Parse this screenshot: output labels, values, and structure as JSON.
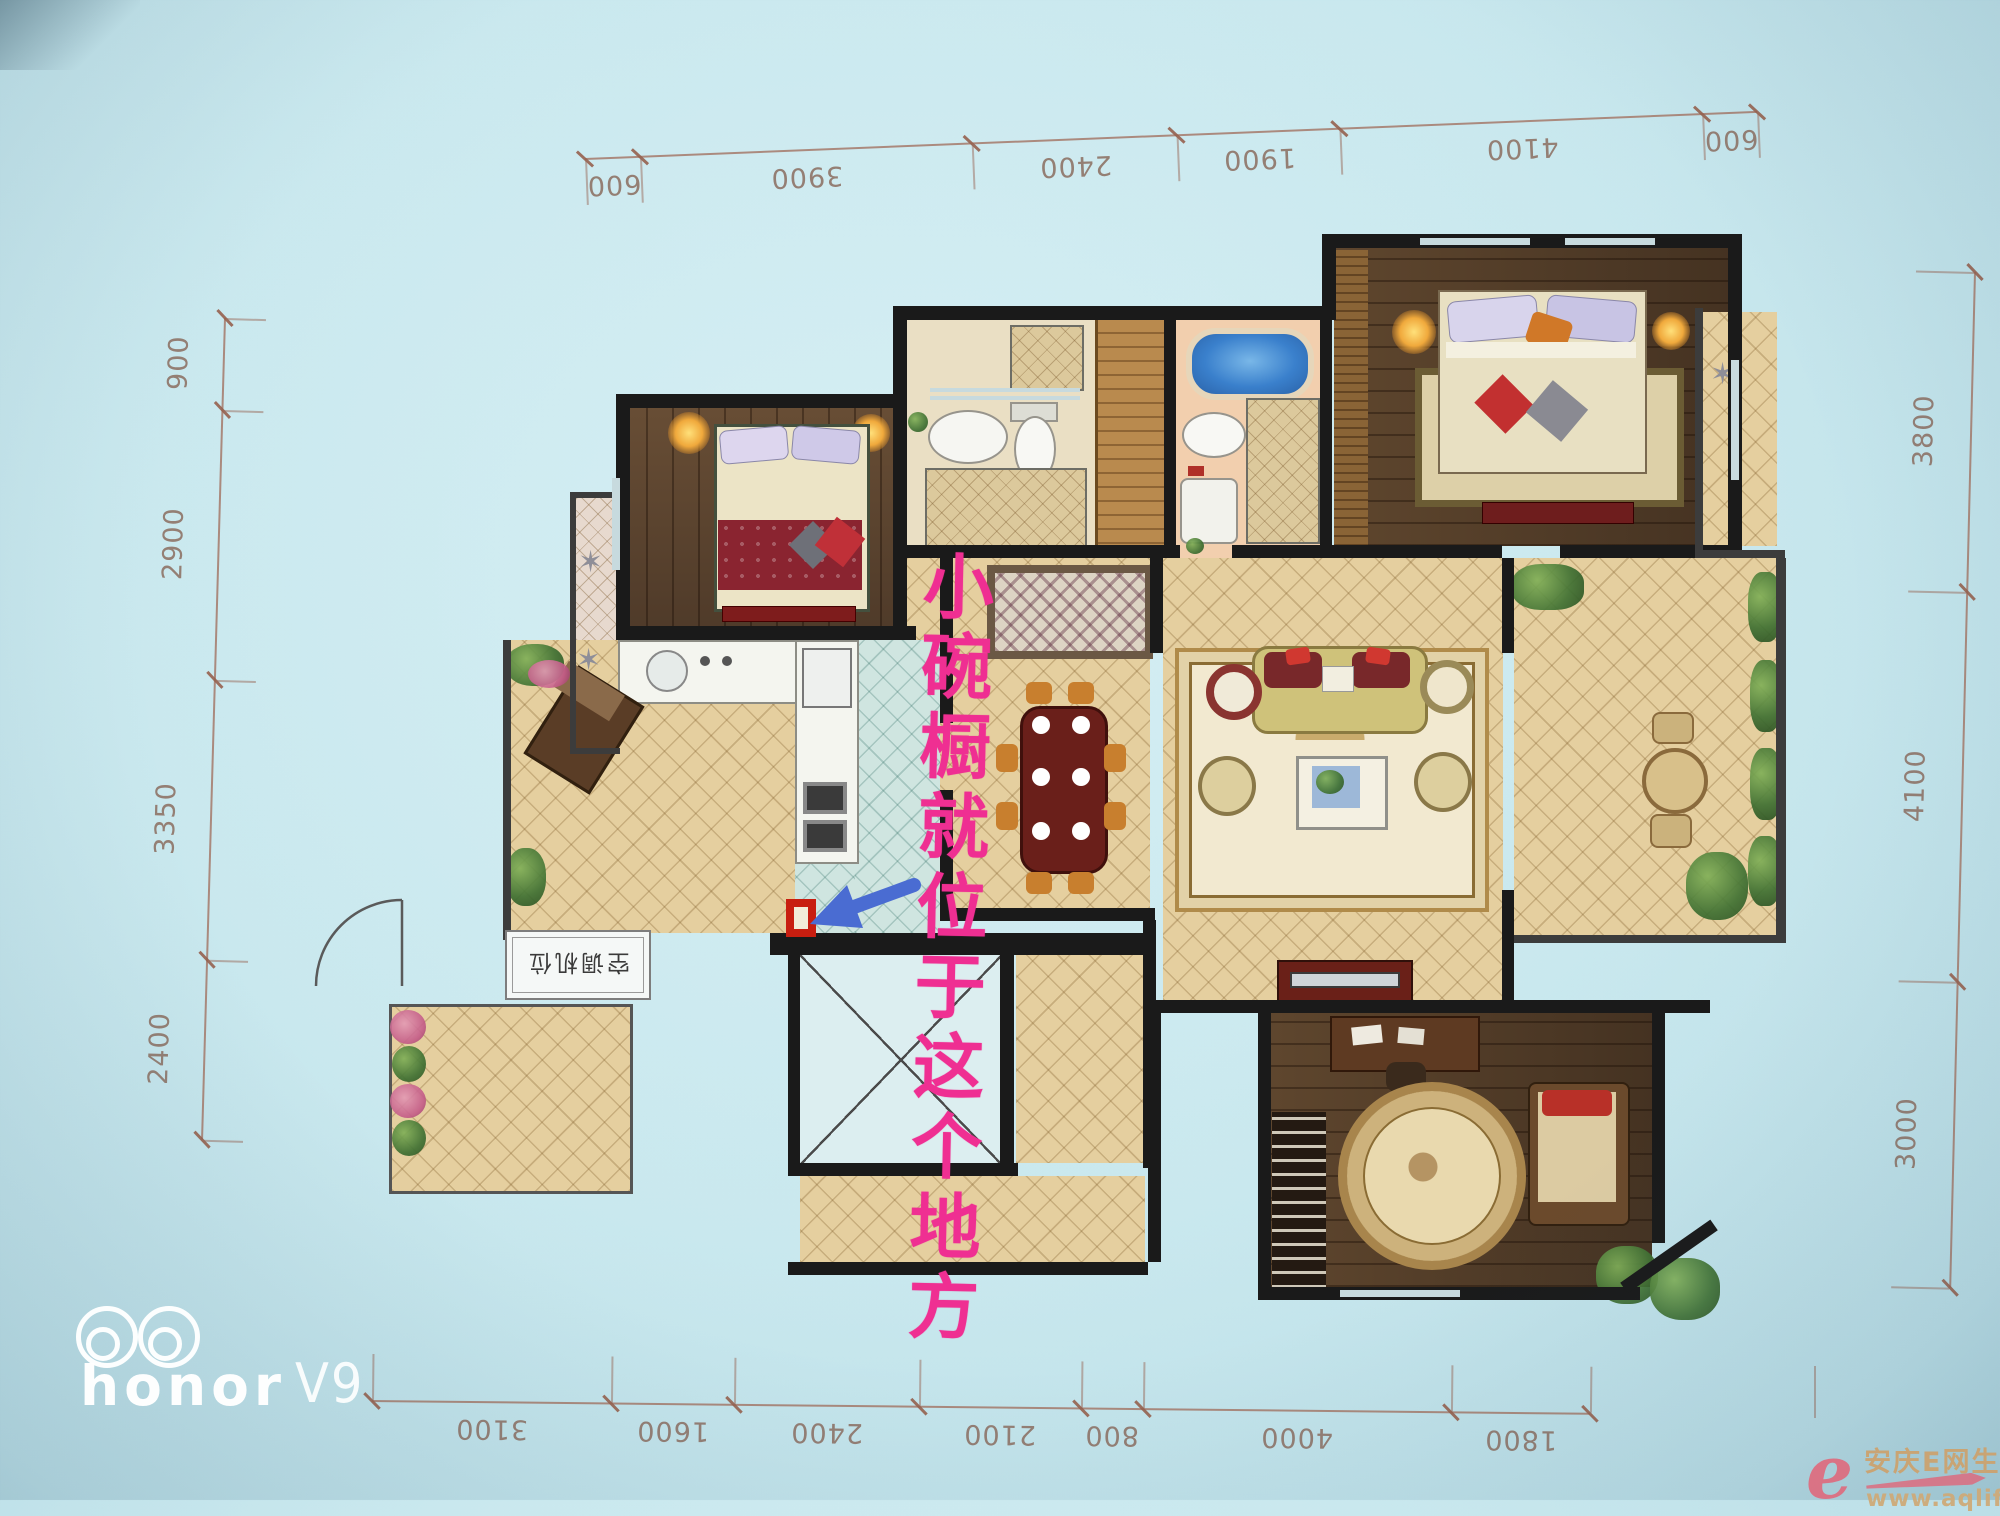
{
  "annotation": {
    "note": "小碗橱就位于这个地方",
    "colors": {
      "note": "#ef2f92",
      "arrow": "#4a6cd2",
      "marker": "#c81e10"
    }
  },
  "floorplan": {
    "labels": {
      "ac_platform": "空调机位"
    },
    "dimensions_mm": {
      "top": [
        "600",
        "3900",
        "2400",
        "1900",
        "4100",
        "600"
      ],
      "bottom": [
        "3100",
        "1600",
        "2400",
        "2100",
        "800",
        "4000",
        "1800"
      ],
      "left": [
        "900",
        "2900",
        "3350",
        "2400"
      ],
      "right": [
        "3800",
        "4100",
        "3000"
      ]
    }
  },
  "watermarks": {
    "device": {
      "brand": "honor",
      "model": "V9"
    },
    "site": {
      "logo": "e",
      "name": "安庆E网生活",
      "url": "www.aqlife.com"
    }
  }
}
